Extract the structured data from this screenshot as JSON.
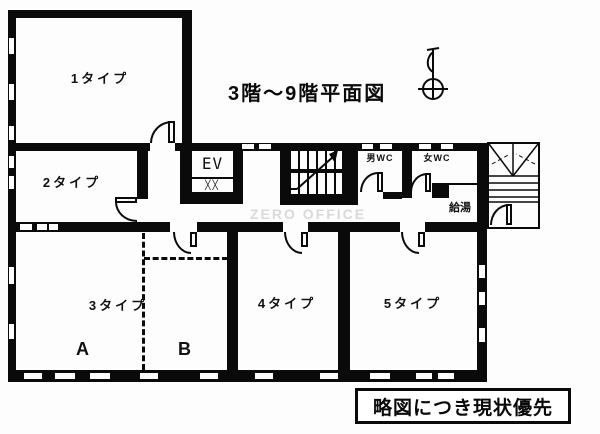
{
  "title": "3階〜9階平面図",
  "watermark": "ZERO OFFICE",
  "caption": "略図につき現状優先",
  "rooms": {
    "type1": {
      "label": "1タイプ"
    },
    "type2": {
      "label": "2タイプ"
    },
    "type3": {
      "label": "3タイプ",
      "section_a": "A",
      "section_b": "B"
    },
    "type4": {
      "label": "4タイプ"
    },
    "type5": {
      "label": "5タイプ"
    }
  },
  "facilities": {
    "elevator": {
      "label": "EV",
      "door_marks": "╳╳"
    },
    "wc_men": {
      "label": "男WC"
    },
    "wc_women": {
      "label": "女WC"
    },
    "hot_water": {
      "label": "給湯"
    }
  },
  "colors": {
    "wall": "#0a0a0a",
    "background": "#ffffff",
    "watermark": "#d9d9d9"
  }
}
